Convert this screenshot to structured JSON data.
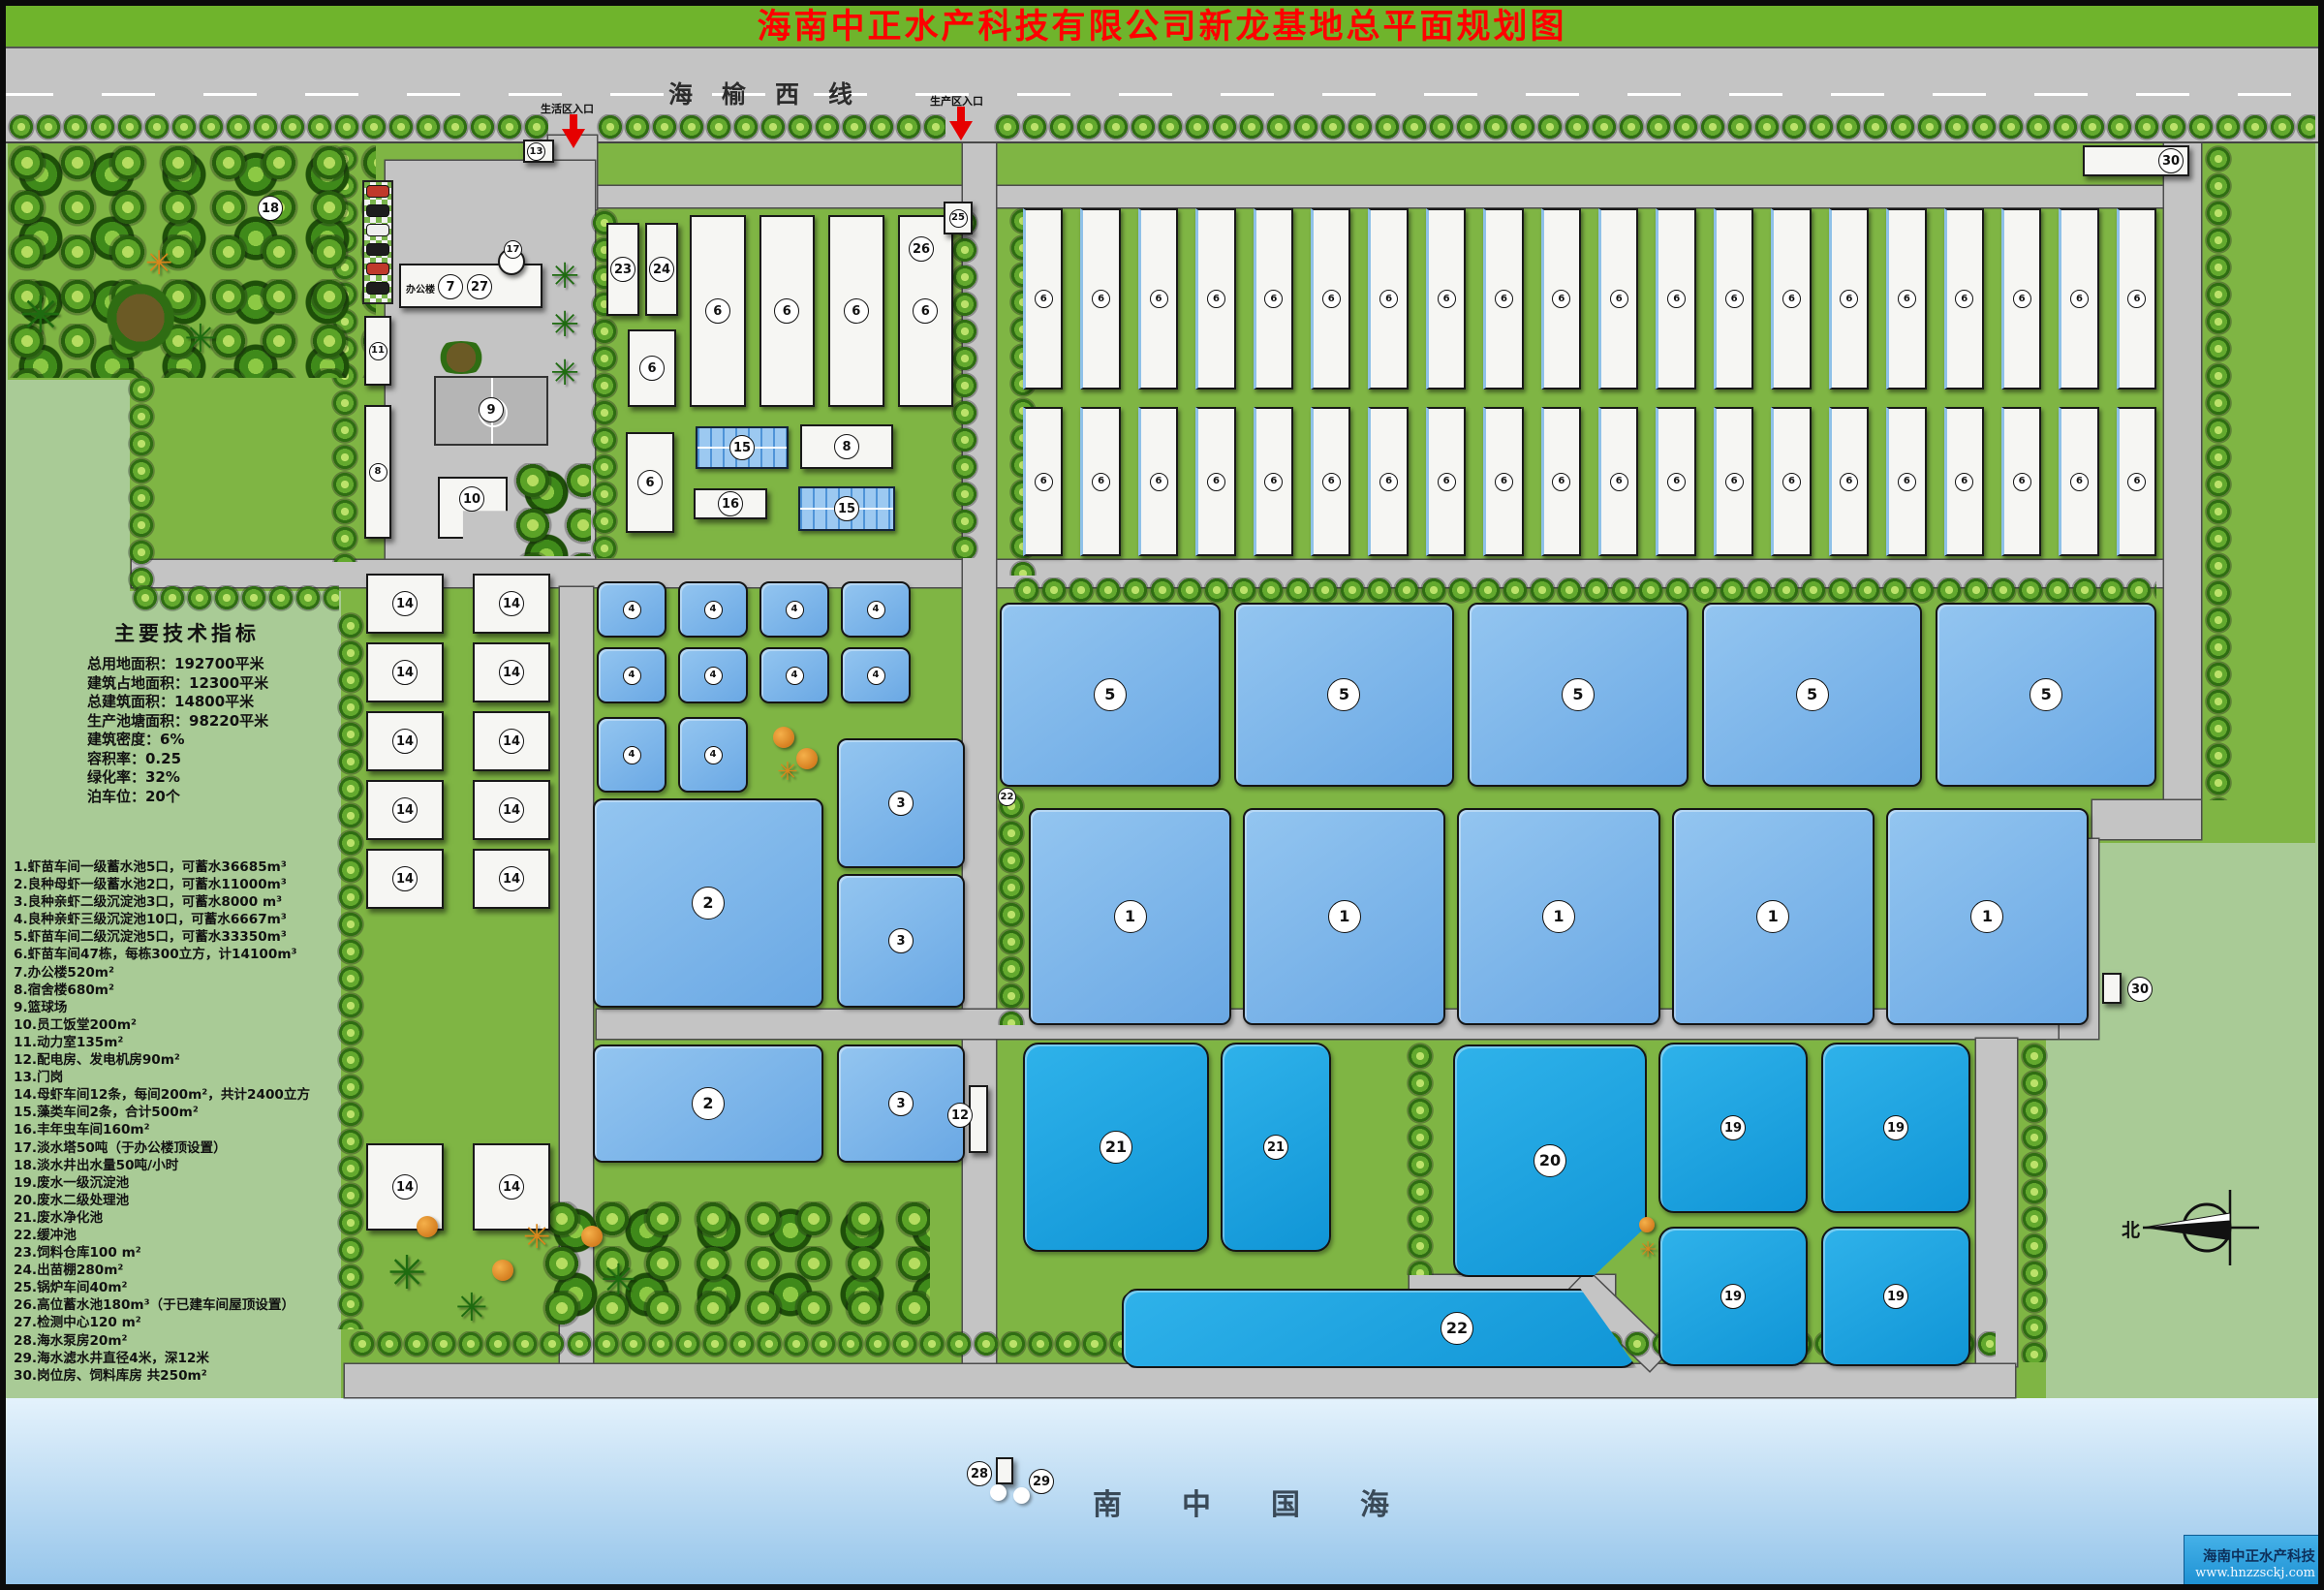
{
  "title": "海南中正水产科技有限公司新龙基地总平面规划图",
  "highway": {
    "name": "海榆西线",
    "entrance_living": "生活区入口",
    "entrance_production": "生产区入口"
  },
  "indicators": {
    "heading": "主要技术指标",
    "lines": [
      "总用地面积：192700平米",
      "建筑占地面积：12300平米",
      "总建筑面积：14800平米",
      "生产池塘面积：98220平米",
      "建筑密度：6%",
      "容积率：0.25",
      "绿化率：32%",
      "泊车位：20个"
    ]
  },
  "legend": [
    "1.虾苗车间一级蓄水池5口，可蓄水36685m³",
    "2.良种母虾一级蓄水池2口，可蓄水11000m³",
    "3.良种亲虾二级沉淀池3口，可蓄水8000 m³",
    "4.良种亲虾三级沉淀池10口，可蓄水6667m³",
    "5.虾苗车间二级沉淀池5口，可蓄水33350m³",
    "6.虾苗车间47栋，每栋300立方，计14100m³",
    "7.办公楼520m²",
    "8.宿舍楼680m²",
    "9.篮球场",
    "10.员工饭堂200m²",
    "11.动力室135m²",
    "12.配电房、发电机房90m²",
    "13.门岗",
    "14.母虾车间12条，每间200m²，共计2400立方",
    "15.藻类车间2条，合计500m²",
    "16.丰年虫车间160m²",
    "17.淡水塔50吨（于办公楼顶设置）",
    "18.淡水井出水量50吨/小时",
    "19.废水一级沉淀池",
    "20.废水二级处理池",
    "21.废水净化池",
    "22.缓冲池",
    "23.饲料仓库100 m²",
    "24.出苗棚280m²",
    "25.锅炉车间40m²",
    "26.高位蓄水池180m³（于已建车间屋顶设置）",
    "27.检测中心120 m²",
    "28.海水泵房20m²",
    "29.海水滤水井直径4米，深12米",
    "30.岗位房、饲料库房 共250m²"
  ],
  "labels": {
    "n1": "1",
    "n2": "2",
    "n3": "3",
    "n4": "4",
    "n5": "5",
    "n6": "6",
    "n7": "7",
    "n8": "8",
    "n9": "9",
    "n10": "10",
    "n11": "11",
    "n12": "12",
    "n13": "13",
    "n14": "14",
    "n15": "15",
    "n16": "16",
    "n17": "17",
    "n18": "18",
    "n19": "19",
    "n20": "20",
    "n21": "21",
    "n22": "22",
    "n23": "23",
    "n24": "24",
    "n25": "25",
    "n26": "26",
    "n27": "27",
    "n28": "28",
    "n29": "29",
    "n30": "30",
    "office": "办公楼",
    "north": "北"
  },
  "map": {
    "workshop_row1": [
      "6",
      "6",
      "6",
      "6",
      "6",
      "6",
      "6",
      "6",
      "6",
      "6",
      "6",
      "6",
      "6",
      "6",
      "6",
      "6",
      "6",
      "6",
      "6",
      "6"
    ],
    "workshop_row2": [
      "6",
      "6",
      "6",
      "6",
      "6",
      "6",
      "6",
      "6",
      "6",
      "6",
      "6",
      "6",
      "6",
      "6",
      "6",
      "6",
      "6",
      "6",
      "6",
      "6"
    ],
    "workshop_mid": [
      "6",
      "6",
      "6",
      "6"
    ],
    "pond5_row": [
      "5",
      "5",
      "5",
      "5",
      "5"
    ],
    "pond1_row": [
      "1",
      "1",
      "1",
      "1",
      "1"
    ],
    "pond4_row_a": [
      "4",
      "4",
      "4",
      "4"
    ],
    "pond4_row_b": [
      "4",
      "4",
      "4",
      "4"
    ],
    "pond4_row_c": [
      "4",
      "4"
    ],
    "pond19_grid": [
      "19",
      "19",
      "19",
      "19"
    ],
    "b14_grid": [
      "14",
      "14",
      "14",
      "14",
      "14",
      "14",
      "14",
      "14",
      "14",
      "14"
    ],
    "b14_lower": [
      "14",
      "14"
    ]
  },
  "sea": {
    "name": "南中国海"
  },
  "footer": {
    "company": "海南中正水产科技",
    "website": "www.hnzzsckj.com"
  },
  "colors": {
    "title_red": "#ff0000",
    "banner_green": "#6fb42c",
    "site_green": "#7fb544",
    "legend_green": "#a9cb96",
    "road_gray": "#c4c4c4",
    "pond_soft": "#76b3e8",
    "pond_vivid": "#16a0e1",
    "sea_blue": "#94c4ea",
    "footer_blue": "#1b8fd2"
  }
}
